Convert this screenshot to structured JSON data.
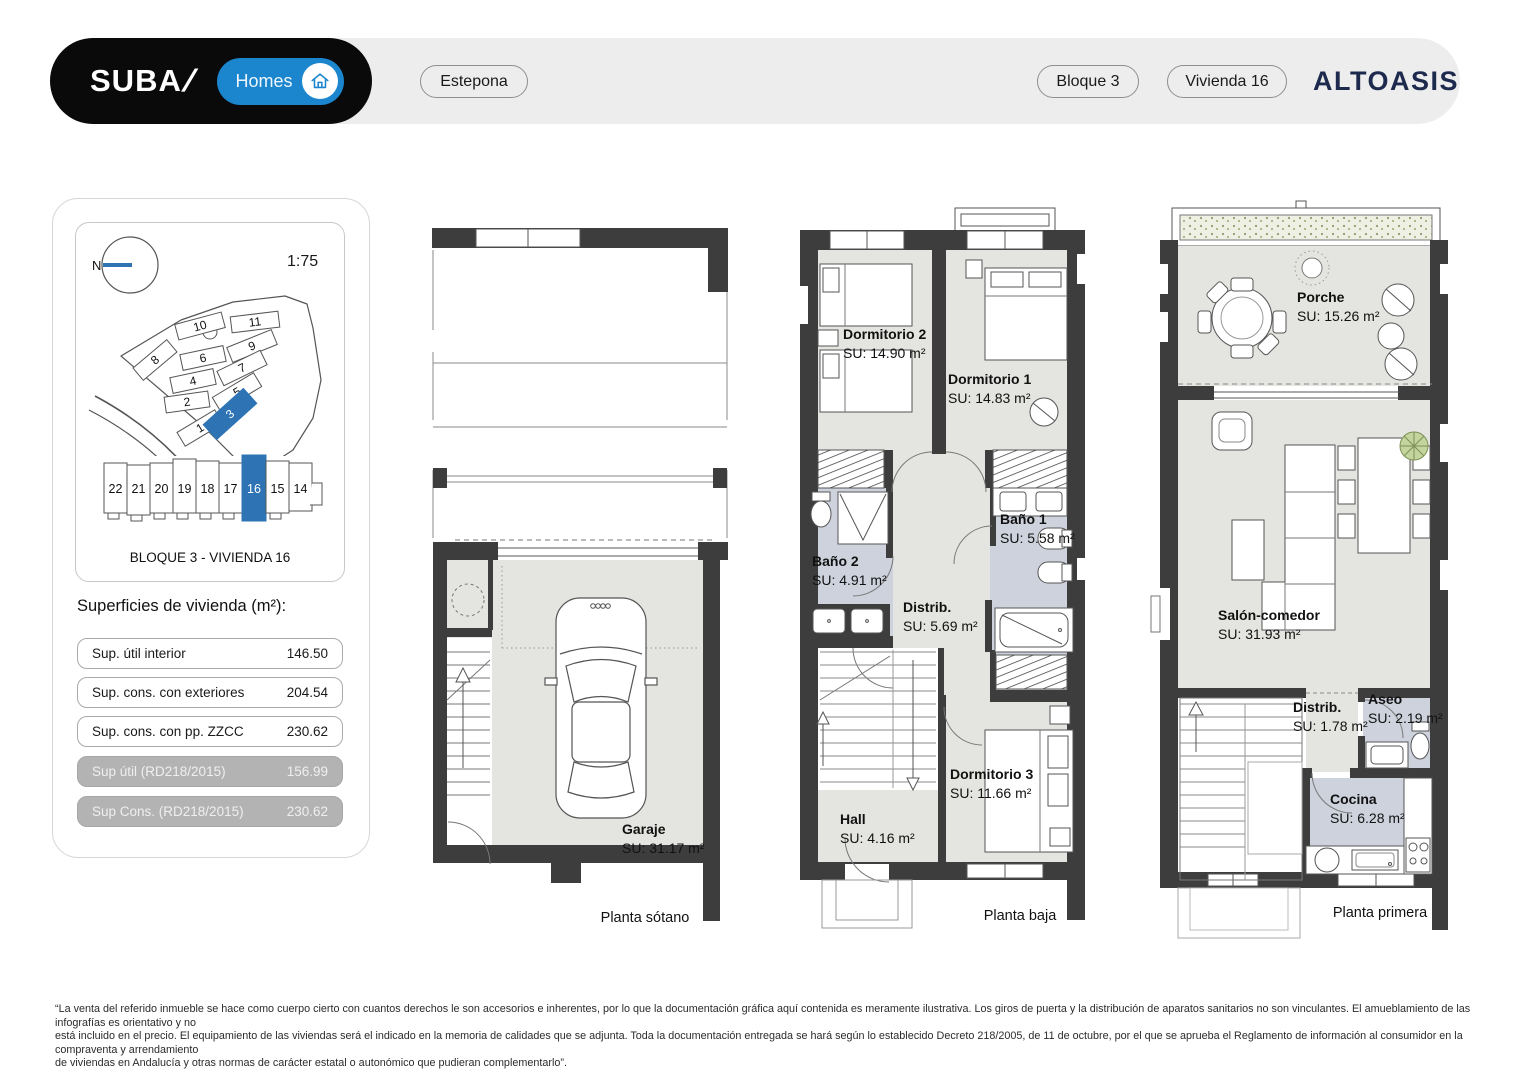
{
  "header": {
    "brand": "SUBA",
    "brand_mark": "/",
    "homes_label": "Homes",
    "location_badge": "Estepona",
    "block_badge": "Bloque 3",
    "unit_badge": "Vivienda 16",
    "logo": "ALTOASIS"
  },
  "sidebar": {
    "compass_label": "N",
    "scale": "1:75",
    "site_plots": [
      "1",
      "2",
      "3",
      "4",
      "5",
      "6",
      "7",
      "8",
      "9",
      "10",
      "11"
    ],
    "highlighted_plot": "3",
    "units": [
      "22",
      "21",
      "20",
      "19",
      "18",
      "17",
      "16",
      "15",
      "14"
    ],
    "highlighted_unit": "16",
    "strip_caption": "BLOQUE 3 - VIVIENDA 16",
    "surfaces_title": "Superficies de vivienda (m²):",
    "surface_rows": [
      {
        "label": "Sup. útil interior",
        "value": "146.50",
        "muted": false
      },
      {
        "label": "Sup. cons. con exteriores",
        "value": "204.54",
        "muted": false
      },
      {
        "label": "Sup. cons. con pp. ZZCC",
        "value": "230.62",
        "muted": false
      },
      {
        "label": "Sup útil (RD218/2015)",
        "value": "156.99",
        "muted": true
      },
      {
        "label": "Sup Cons. (RD218/2015)",
        "value": "230.62",
        "muted": true
      }
    ]
  },
  "plans": {
    "sotano": {
      "caption": "Planta sótano",
      "garaje": {
        "name": "Garaje",
        "su": "SU: 31.17 m²"
      }
    },
    "baja": {
      "caption": "Planta baja",
      "dorm2": {
        "name": "Dormitorio 2",
        "su": "SU: 14.90 m²"
      },
      "dorm1": {
        "name": "Dormitorio 1",
        "su": "SU: 14.83 m²"
      },
      "bano2": {
        "name": "Baño 2",
        "su": "SU: 4.91 m²"
      },
      "bano1": {
        "name": "Baño 1",
        "su": "SU: 5.58 m²"
      },
      "distrib": {
        "name": "Distrib.",
        "su": "SU: 5.69 m²"
      },
      "dorm3": {
        "name": "Dormitorio 3",
        "su": "SU: 11.66 m²"
      },
      "hall": {
        "name": "Hall",
        "su": "SU: 4.16 m²"
      }
    },
    "primera": {
      "caption": "Planta primera",
      "porche": {
        "name": "Porche",
        "su": "SU: 15.26 m²"
      },
      "salon": {
        "name": "Salón-comedor",
        "su": "SU: 31.93 m²"
      },
      "distrib": {
        "name": "Distrib.",
        "su": "SU: 1.78 m²"
      },
      "aseo": {
        "name": "Aseo",
        "su": "SU: 2.19 m²"
      },
      "cocina": {
        "name": "Cocina",
        "su": "SU: 6.28 m²"
      }
    }
  },
  "footer": {
    "lines": [
      "“La venta del referido inmueble se hace como cuerpo cierto con cuantos derechos le son accesorios e inherentes, por lo que la documentación gráfica aquí contenida es meramente ilustrativa. Los giros de puerta y la distribución de aparatos sanitarios no son vinculantes. El amueblamiento de las infografías es orientativo y no",
      "está incluido en el precio. El equipamiento de las viviendas será el indicado en la memoria de calidades que se adjunta. Toda la documentación entregada se hará según lo establecido Decreto 218/2005, de 11 de octubre, por el que se aprueba el Reglamento de información al consumidor en la compraventa y arrendamiento",
      "de viviendas en Andalucía y otras normas de carácter estatal o autonómico que pudieran complementarlo”."
    ]
  },
  "colors": {
    "accent_blue": "#2e74b5",
    "homes_blue": "#1b86cd",
    "wall": "#3d3d3d",
    "floor": "#e4e5e0",
    "bath_floor": "#cdd2dd",
    "header_bar": "#ededed"
  }
}
